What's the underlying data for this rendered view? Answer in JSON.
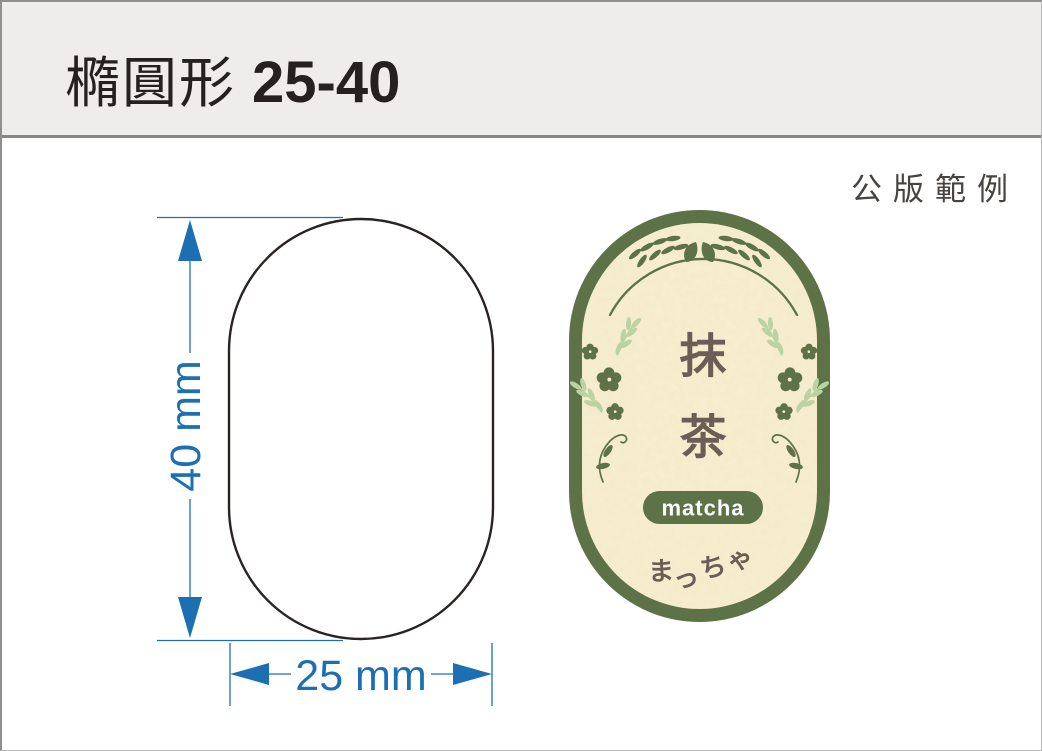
{
  "page": {
    "title": "橢圓形",
    "title_size": "25-40",
    "caption": "公版範例"
  },
  "diagram": {
    "height_label": "40 mm",
    "width_label": "25 mm",
    "dimension_color": "#1d6fb3",
    "outline_color": "#292321"
  },
  "sample_label": {
    "name_char_top": "抹",
    "name_char_bottom": "茶",
    "badge_text": "matcha",
    "kana": [
      "ま",
      "っ",
      "ち",
      "ゃ"
    ],
    "colors": {
      "border_green": "#5d7247",
      "leaf_light_green": "#b9d3a3",
      "paper_cream": "#f7efd0",
      "text_taupe": "#6b5e55",
      "badge_text_white": "#ffffff"
    }
  }
}
